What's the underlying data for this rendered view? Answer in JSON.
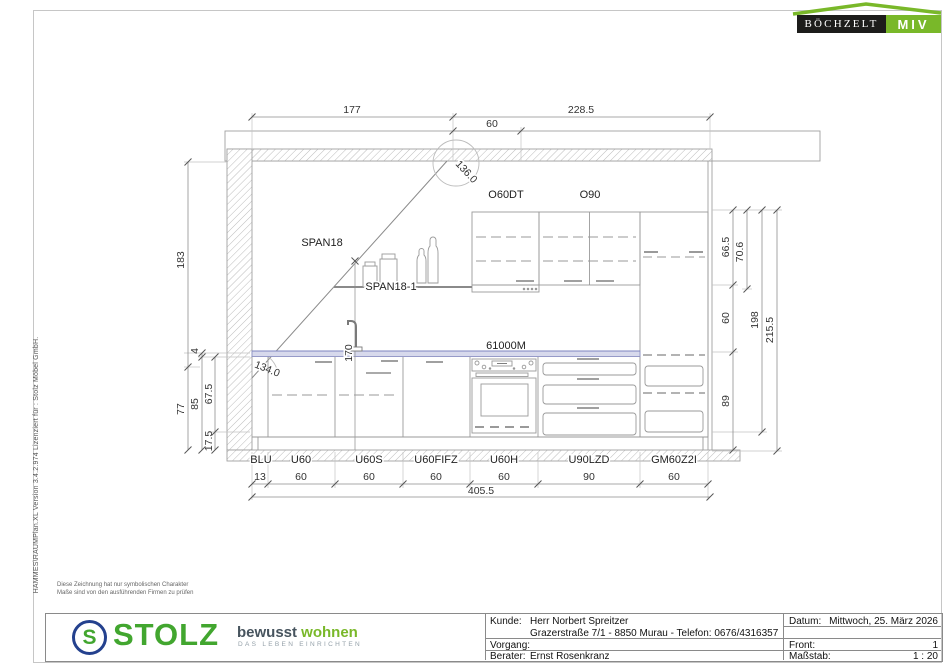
{
  "branding": {
    "boechzelt_name": "BÖCHZELT",
    "boechzelt_suffix": "MIV",
    "stolz_initial": "S",
    "stolz_name": "STOLZ",
    "claim_a": "bewusst",
    "claim_b": " wohnen",
    "claim_sub": "DAS LEBEN EINRICHTEN"
  },
  "app_info": "HAMMES\\RAUMPlan.XL   Version 3.4.2.974    Lizenziert für : Stolz Möbel GmbH.",
  "disclaimer": {
    "line1": "Diese Zeichnung hat nur symbolischen Charakter",
    "line2": "Maße sind von den ausführenden Firmen zu prüfen"
  },
  "drawing": {
    "top_dims": {
      "d177": "177",
      "d60": "60",
      "d2285": "228.5"
    },
    "angles": {
      "top": "136.0",
      "bottom": "134.0"
    },
    "left_dims": {
      "d183": "183",
      "d77": "77",
      "d4": "4",
      "d85": "85",
      "d675": "67.5",
      "d175": "17.5"
    },
    "right_dims": {
      "d665": "66.5",
      "d706": "70.6",
      "d60": "60",
      "d89": "89",
      "d198": "198",
      "d2155": "215.5"
    },
    "labels": {
      "o60dt": "O60DT",
      "o90": "O90",
      "span18": "SPAN18",
      "span18_1": "SPAN18-1",
      "worktop": "61000M",
      "h170": "170"
    },
    "cabinet_labels": [
      "BLU",
      "U60",
      "U60S",
      "U60FIFZ",
      "U60H",
      "U90LZD",
      "GM60Z2I"
    ],
    "bottom_dims": [
      "13",
      "60",
      "60",
      "60",
      "60",
      "90",
      "60"
    ],
    "total_width": "405.5",
    "colors": {
      "worktop_fill": "#d7d9ec",
      "worktop_edge": "#8d92c4"
    }
  },
  "footer": {
    "kunde_label": "Kunde:",
    "kunde_value": "Herr Norbert Spreitzer",
    "address": "Grazerstraße 7/1 - 8850 Murau - Telefon: 0676/4316357",
    "vorgang_label": "Vorgang:",
    "vorgang_value": "",
    "berater_label": "Berater:",
    "berater_value": "Ernst Rosenkranz",
    "datum_label": "Datum:",
    "datum_value": "Mittwoch, 25. März 2026",
    "front_label": "Front:",
    "front_value": "1",
    "massstab_label": "Maßstab:",
    "massstab_value": "1 : 20"
  }
}
